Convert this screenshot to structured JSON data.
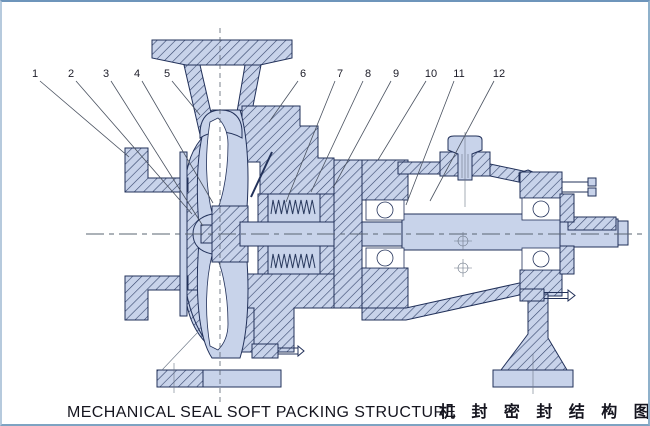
{
  "figure": {
    "caption_en": "MECHANICAL SEAL SOFT PACKING STRUCTURE",
    "caption_zh": "机 封 密 封 结 构 图"
  },
  "colors": {
    "background": "#ffffff",
    "border": "#7fa3c4",
    "part_fill": "#c8d3ea",
    "hatch_line": "#33436a",
    "outline": "#22315a",
    "centerline": "#5a6472",
    "leader_line": "#4a5260",
    "label_text": "#1c1c28"
  },
  "callouts": [
    {
      "num": "1",
      "x": 33,
      "y": 71,
      "tip_x": 127,
      "tip_y": 155
    },
    {
      "num": "2",
      "x": 69,
      "y": 71,
      "tip_x": 190,
      "tip_y": 212
    },
    {
      "num": "3",
      "x": 104,
      "y": 71,
      "tip_x": 201,
      "tip_y": 224
    },
    {
      "num": "4",
      "x": 135,
      "y": 71,
      "tip_x": 211,
      "tip_y": 201
    },
    {
      "num": "5",
      "x": 165,
      "y": 71,
      "tip_x": 198,
      "tip_y": 113
    },
    {
      "num": "6",
      "x": 301,
      "y": 71,
      "tip_x": 267,
      "tip_y": 120
    },
    {
      "num": "7",
      "x": 338,
      "y": 71,
      "tip_x": 284,
      "tip_y": 200
    },
    {
      "num": "8",
      "x": 366,
      "y": 71,
      "tip_x": 309,
      "tip_y": 190
    },
    {
      "num": "9",
      "x": 394,
      "y": 71,
      "tip_x": 331,
      "tip_y": 186
    },
    {
      "num": "10",
      "x": 429,
      "y": 71,
      "tip_x": 376,
      "tip_y": 158
    },
    {
      "num": "11",
      "x": 457,
      "y": 71,
      "tip_x": 404,
      "tip_y": 203
    },
    {
      "num": "12",
      "x": 497,
      "y": 71,
      "tip_x": 428,
      "tip_y": 199
    }
  ]
}
